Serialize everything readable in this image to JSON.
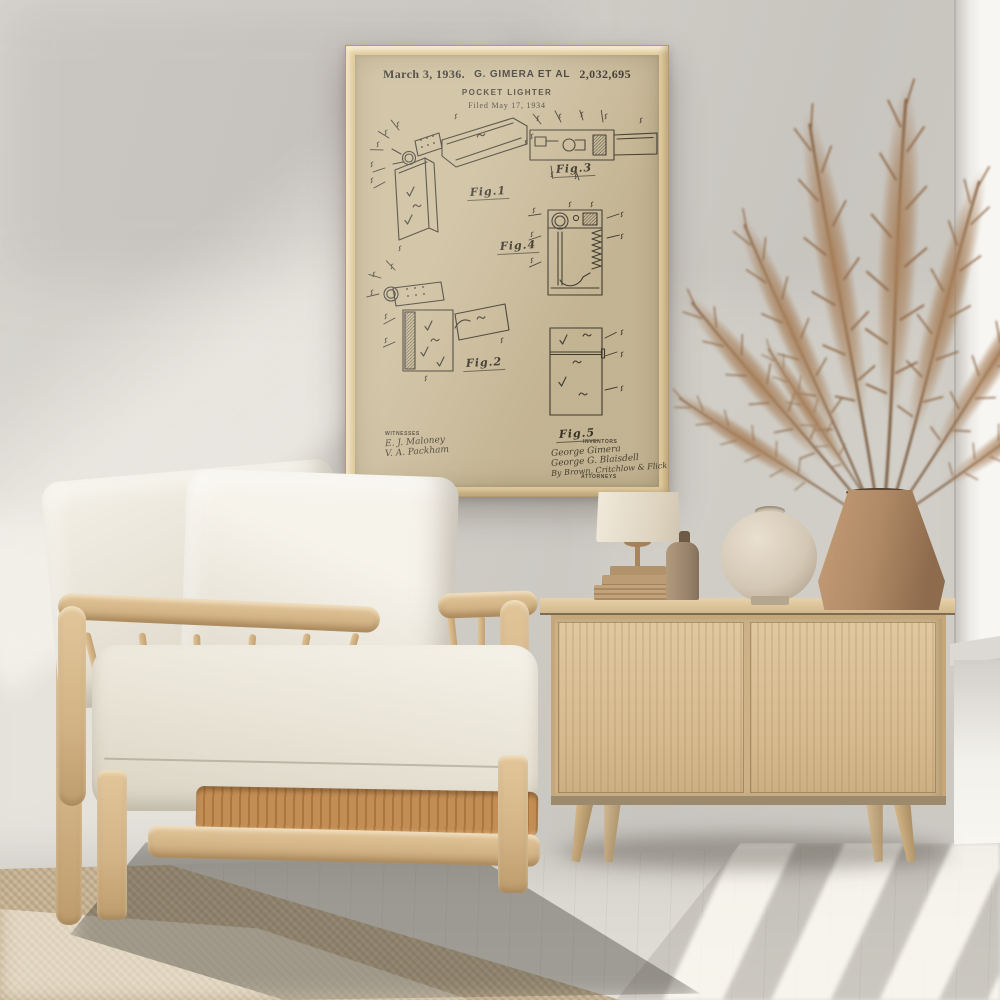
{
  "poster": {
    "header": {
      "date": "March 3, 1936.",
      "inventors_line": "G. GIMERA ET AL",
      "patent_number": "2,032,695"
    },
    "title": "POCKET LIGHTER",
    "filed": "Filed May 17, 1934",
    "figure_labels": [
      "Fig.1",
      "Fig.3",
      "Fig.4",
      "Fig.2",
      "Fig.5"
    ],
    "witnesses": {
      "heading": "WITNESSES",
      "signatures": [
        "E. J. Maloney",
        "V. A. Packham"
      ]
    },
    "inventors_block": {
      "heading": "INVENTORS",
      "signatures": [
        "George Gimera",
        "George G. Blaisdell"
      ],
      "by_line": "By Brown, Critchlow & Flick",
      "attorneys_label": "ATTORNEYS"
    }
  },
  "colors": {
    "wall": "#cfccc6",
    "poster_paper": "#c9ba98",
    "poster_ink": "#2e2a24",
    "frame_wood": "#e0cb9e",
    "chair_wood": "#d9bd92",
    "cushion": "#efebe0",
    "rattan": "#c08b53",
    "sideboard_wood": "#dcc49c",
    "floor": "#dbd8d1",
    "rug": "#c6b292",
    "large_vase": "#b08a66",
    "round_vase": "#d9cfc0",
    "bottle": "#a08a70",
    "lamp_shade": "#ece4d4",
    "pampas_grass": "#a07a58"
  }
}
